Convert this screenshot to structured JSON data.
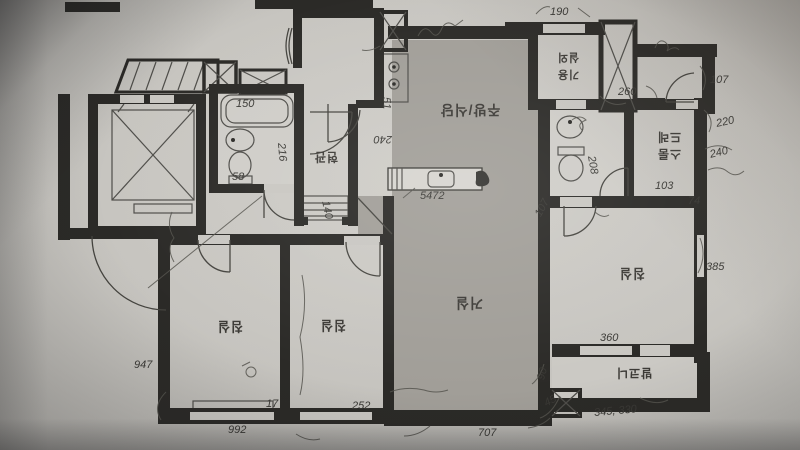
{
  "scene": {
    "kind": "photo of a hand-annotated apartment floor plan, plan printed upside-down relative to camera",
    "colors": {
      "paper": "#c8c6c1",
      "floor_shade": "#a19e98",
      "wall": "#2b2a27",
      "pencil": "#4a4944",
      "ink": "#35332f"
    }
  },
  "rooms": {
    "kitchen": {
      "label": "주방/식당"
    },
    "living": {
      "label": "거실"
    },
    "bedroom_left": {
      "label": "침실"
    },
    "bedroom_middle": {
      "label": "침실"
    },
    "bedroom_right": {
      "label": "침실"
    },
    "entrance": {
      "label": "현관"
    },
    "dressroom": {
      "label_line1": "드레",
      "label_line2": "스룸"
    },
    "utility": {
      "label_line1": "실외",
      "label_line2": "기용"
    },
    "balcony": {
      "label": "발코니"
    }
  },
  "annotations": [
    {
      "text": "190"
    },
    {
      "text": "150"
    },
    {
      "text": "58"
    },
    {
      "text": "216"
    },
    {
      "text": "140"
    },
    {
      "text": "240"
    },
    {
      "text": "5472"
    },
    {
      "text": "260"
    },
    {
      "text": "107"
    },
    {
      "text": "220"
    },
    {
      "text": "103"
    },
    {
      "text": "208"
    },
    {
      "text": "385"
    },
    {
      "text": "360"
    },
    {
      "text": "345, 330"
    },
    {
      "text": "947"
    },
    {
      "text": "992"
    },
    {
      "text": "707"
    },
    {
      "text": "252"
    },
    {
      "text": "17"
    },
    {
      "text": "107"
    },
    {
      "text": "90"
    },
    {
      "text": "45"
    },
    {
      "text": "51"
    },
    {
      "text": "240"
    },
    {
      "text": "74"
    }
  ]
}
